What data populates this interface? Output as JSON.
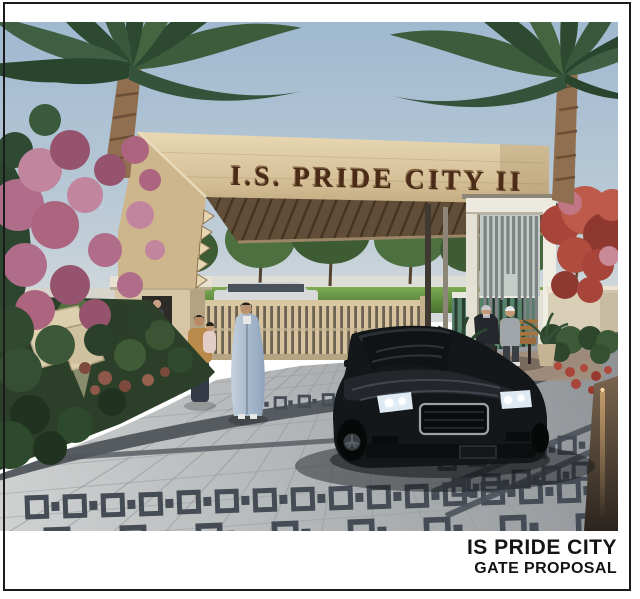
{
  "page": {
    "background": "#ffffff",
    "frame_color": "#1b1b1b"
  },
  "rendering": {
    "type": "3d-architectural-visualization",
    "subject": "Residential community entrance gate with palm trees, guard cabin, visitors, patterned paving and a dark car exiting",
    "sign_text": "I.S. PRIDE CITY II",
    "sign_text_color": "#4a2b17",
    "colors": {
      "sky": "#a5bed3",
      "stone_beam": "#d9c49e",
      "pergola": "#6e5940",
      "lawn": "#5f8c41",
      "paving": "#b5b8ba",
      "paving_pattern": "#464c55",
      "car": "#141719",
      "bougainvillea_pink": "#b56e8c",
      "flame_tree_red": "#ae4538",
      "inner_gate_teal": "#4e7a64",
      "entry_gate_wood": "#d6c39e"
    }
  },
  "caption": {
    "line1": "IS PRIDE CITY",
    "line2": "GATE PROPOSAL",
    "color": "#141414"
  }
}
